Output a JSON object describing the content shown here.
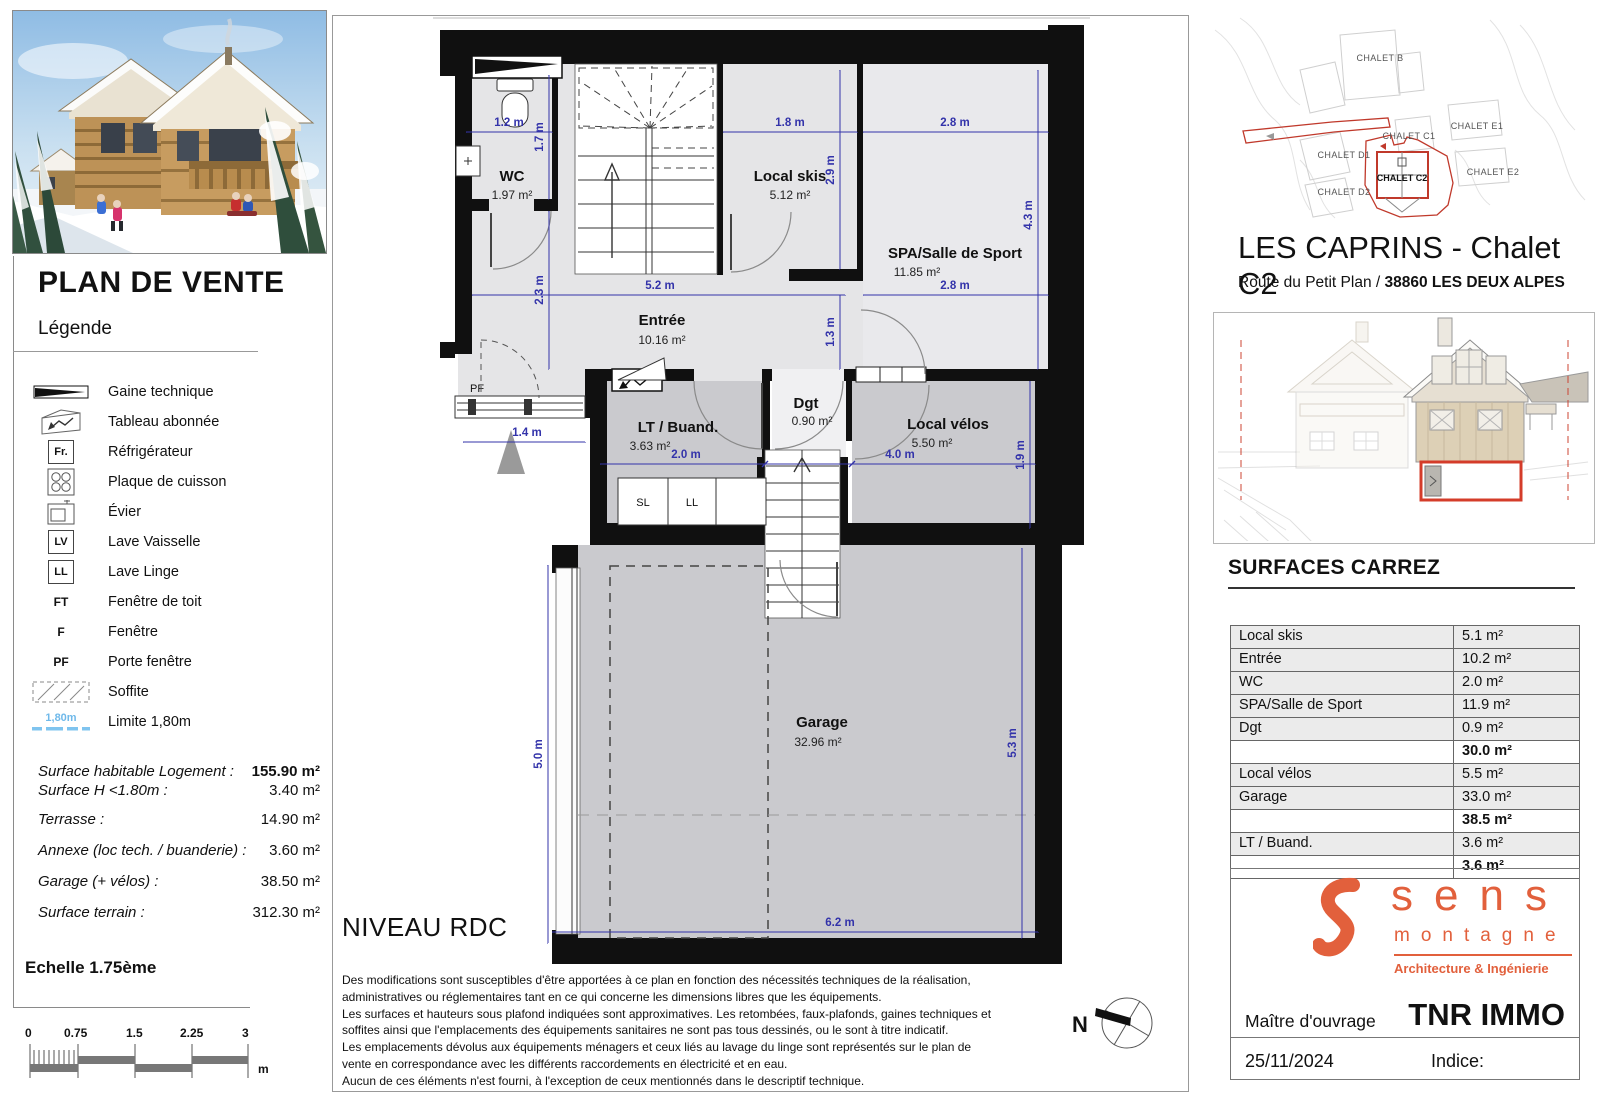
{
  "colors": {
    "dim_blue": "#3333aa",
    "accent_orange": "#e2603c",
    "site_red": "#c0392b",
    "limite_blue": "#7fc4ef"
  },
  "left_panel": {
    "title": "PLAN DE VENTE",
    "legend_title": "Légende",
    "legend": [
      {
        "label": "Gaine technique"
      },
      {
        "label": "Tableau abonnée"
      },
      {
        "abbr": "Fr.",
        "label": "Réfrigérateur"
      },
      {
        "label": "Plaque de cuisson"
      },
      {
        "label": "Évier"
      },
      {
        "abbr": "LV",
        "label": "Lave Vaisselle"
      },
      {
        "abbr": "LL",
        "label": "Lave Linge"
      },
      {
        "abbr": "FT",
        "label": "Fenêtre de toit"
      },
      {
        "abbr": "F",
        "label": "Fenêtre"
      },
      {
        "abbr": "PF",
        "label": "Porte fenêtre"
      },
      {
        "label": "Soffite"
      },
      {
        "abbr": "1,80m",
        "label": "Limite 1,80m"
      }
    ],
    "surfaces": [
      {
        "label": "Surface habitable Logement :",
        "value": "155.90 m²"
      },
      {
        "label": "Surface H <1.80m :",
        "value": "3.40 m²"
      },
      {
        "label": "Terrasse :",
        "value": "14.90 m²"
      },
      {
        "label": "Annexe (loc tech. / buanderie) :",
        "value": "3.60 m²"
      },
      {
        "label": "Garage (+ vélos) :",
        "value": "38.50 m²"
      },
      {
        "label": "Surface terrain :",
        "value": "312.30 m²"
      }
    ],
    "scale_label": "Echelle 1.75ème",
    "scale_ticks": [
      "0",
      "0.75",
      "1.5",
      "2.25",
      "3"
    ],
    "scale_unit": "m"
  },
  "plan": {
    "level_label": "NIVEAU RDC",
    "north_label": "N",
    "pf_label": "PF",
    "closets": [
      "SL",
      "LL"
    ],
    "rooms": [
      {
        "name": "WC",
        "area": "1.97 m²"
      },
      {
        "name": "Local skis",
        "area": "5.12 m²"
      },
      {
        "name": "SPA/Salle de Sport",
        "area": "11.85 m²"
      },
      {
        "name": "Entrée",
        "area": "10.16 m²"
      },
      {
        "name": "LT / Buand.",
        "area": "3.63 m²"
      },
      {
        "name": "Dgt",
        "area": "0.90 m²"
      },
      {
        "name": "Local vélos",
        "area": "5.50 m²"
      },
      {
        "name": "Garage",
        "area": "32.96 m²"
      }
    ],
    "dims": [
      "1.2 m",
      "1.7 m",
      "1.8 m",
      "2.9 m",
      "2.8 m",
      "4.3 m",
      "5.2 m",
      "2.8 m",
      "2.3 m",
      "1.3 m",
      "1.4 m",
      "2.0 m",
      "4.0 m",
      "1.9 m",
      "5.0 m",
      "5.3 m",
      "6.2 m"
    ],
    "disclaimer": [
      "Des modifications sont susceptibles d'être apportées à ce plan en fonction des nécessités techniques de la réalisation,",
      "administratives ou réglementaires tant en ce qui concerne les dimensions libres que les équipements.",
      "Les surfaces et hauteurs sous plafond indiquées sont approximatives. Les retombées, faux-plafonds, gaines techniques et",
      "soffites ainsi que l'emplacements des équipements sanitaires ne sont pas tous dessinés, ou le sont à titre indicatif.",
      "Les emplacements dévolus aux équipements ménagers et ceux liés au lavage du linge sont représentés sur le plan de",
      "vente en correspondance avec les différents raccordements en électricité et en eau.",
      "Aucun de ces éléments n'est fourni, à l'exception de ceux mentionnés dans le descriptif technique."
    ]
  },
  "site": {
    "labels": [
      "CHALET B",
      "CHALET C1",
      "CHALET D1",
      "CHALET D2",
      "CHALET E1",
      "CHALET E2"
    ],
    "highlight": "CHALET C2"
  },
  "right_panel": {
    "title": "LES CAPRINS - Chalet C2",
    "address_normal": "Route du Petit Plan / ",
    "address_bold": "38860 LES DEUX ALPES",
    "carrez_title": "SURFACES CARREZ",
    "table": [
      {
        "label": "Local skis",
        "value": "5.1 m²"
      },
      {
        "label": "Entrée",
        "value": "10.2 m²"
      },
      {
        "label": "WC",
        "value": "2.0 m²"
      },
      {
        "label": "SPA/Salle de Sport",
        "value": "11.9 m²"
      },
      {
        "label": "Dgt",
        "value": "0.9 m²"
      },
      {
        "label": "",
        "value": "30.0 m²"
      },
      {
        "label": "Local vélos",
        "value": "5.5 m²"
      },
      {
        "label": "Garage",
        "value": "33.0 m²"
      },
      {
        "label": "",
        "value": "38.5 m²"
      },
      {
        "label": "LT / Buand.",
        "value": "3.6 m²"
      },
      {
        "label": "",
        "value": "3.6 m²"
      }
    ],
    "logo": {
      "brand": "sens",
      "sub": "montagne",
      "tagline": "Architecture & Ingénierie"
    },
    "owner_label": "Maître d'ouvrage",
    "owner_name": "TNR IMMO",
    "date": "25/11/2024",
    "indice_label": "Indice:"
  }
}
